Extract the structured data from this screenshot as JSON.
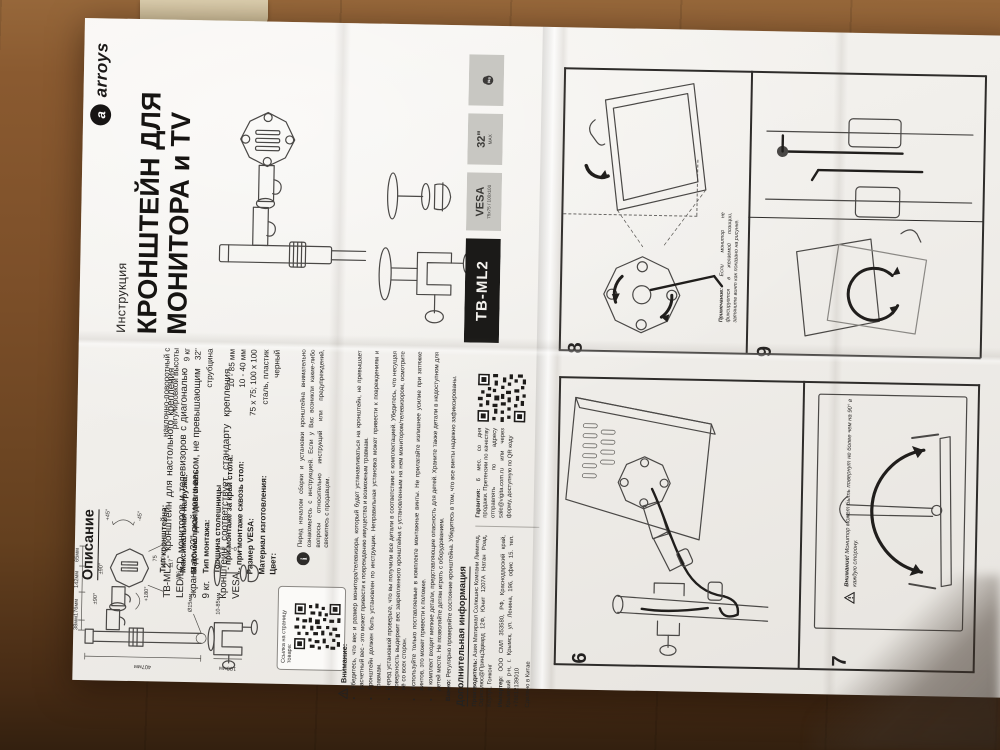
{
  "cover": {
    "brand": "arroys",
    "brand_initial": "a",
    "doc_type": "Инструкция",
    "title_line1": "КРОНШТЕЙН ДЛЯ",
    "title_line2": "МОНИТОРА и TV",
    "badges": {
      "model": "TB-ML2",
      "vesa": "VESA",
      "vesa_sub": "75x75 / 100x100",
      "size": "32\"",
      "size_sub": "MAX",
      "weight": "9kg"
    }
  },
  "description": {
    "title": "Описание",
    "para1": "TB-ML2 - кронштейн для настольного крепления LED/LCD мониторов и телевизоров с диагональю экрана до 32\" дюймов и весом, не превышающим 9 кг.",
    "para2": "Кронштейн соответствует стандарту крепления VESA.",
    "qr_caption": "Ссылка на страницу товара:"
  },
  "specs": {
    "rows": [
      {
        "label": "Тип кронштейна:",
        "value": "наклонно-поворотный с регулировкой высоты"
      },
      {
        "label": "Максимальная нагрузка:",
        "value": "9 кг"
      },
      {
        "label": "Максимальная диагональ:",
        "value": "32\""
      },
      {
        "label": "Тип монтажа:",
        "value": "струбцина"
      },
      {
        "label": "Толщина столешницы",
        "value": ""
      },
      {
        "label": "- при монтаже за край стола:",
        "value": "10 - 85 мм"
      },
      {
        "label": "- при монтаже сквозь стол:",
        "value": "10 - 40 мм"
      },
      {
        "label": "Размер VESA:",
        "value": "75 x 75; 100 x 100"
      },
      {
        "label": "Материал изготовления:",
        "value": "сталь, пластик"
      },
      {
        "label": "Цвет:",
        "value": "черный"
      }
    ]
  },
  "info_note": "Перед началом сборки и установки кронштейна внимательно ознакомьтесь с инструкцией. Если у Вас возникли какие-либо вопросы относительно инструкций или предупреждений, свяжитесь с продавцом.",
  "warnings": {
    "heading": "Внимание:",
    "bullets": [
      "Убедитесь, что вес и размер монитора/телевизора, который будет устанавливаться на кронштейн, не превышает расчетный вес - это может привести к повреждению имущества и возможным травмам.",
      "Кронштейн должен быть установлен по инструкции. Неправильная установка может привести к повреждениям и травмам.",
      "Перед установкой проверьте, что вы получили все детали в соответствии с комплектацией. Убедитесь, что несущая поверхность выдержит вес закрепленного кронштейна с установленным на нем монитором/телевизором, осмотрите её со всех сторон.",
      "Используйте только поставляемые в комплекте монтажные винты. Не прилагайте излишнее усилие при затяжке винтов, это может привести к поломке.",
      "В комплект входят мелкие детали, представляющие опасность для детей. Храните также детали в недоступном для детей месте. Не позволяйте детям играть с оборудованием."
    ],
    "important_label": "Важно:",
    "important": "Регулярно проверяйте состояние кронштейна. Убедитесь в том, что все винты надежно зафиксированы."
  },
  "additional": {
    "heading": "Дополнительная информация",
    "manufacturer_label": "Производитель:",
    "manufacturer": "Азия Матириал Солюшнс Компани Лимитед, Офисплюс@ПринцЭдвард 12Ф, Юнит 1207А Натан Роад, Коулун, Гонконг",
    "importer_label": "Импортер:",
    "importer": "ООО СМЛ 353580, РФ, Краснодарский край, Крымский р-н, г. Крымск, ул. Ленина, 196, офис 15. тел. +78612139010",
    "made_in": "Сделано в Китае",
    "warranty_label": "Гарантия:",
    "warranty": "6 мес. со дня продажи. Претензии по качеству отправлять по адресу sale@vigita.com.ru или через форму, доступную по QR коду"
  },
  "steps": {
    "s6": "6",
    "s7": "7",
    "s8": "8",
    "s9": "9",
    "s8_note_label": "Примечание:",
    "s8_note": "Если монитор не фиксируется в желаемой позиции, затяните винт как показано на рисунке.",
    "s7_warning_label": "Внимание!",
    "s7_warning": "Монитор может быть повернут не более чем на 90° в каждую сторону."
  },
  "dims": {
    "d65": "65мм",
    "d142": "142мм",
    "d176": "176мм",
    "d38": "38мм",
    "d407": "407мм",
    "d100": "100мм",
    "d15": "Ø15мм",
    "r90a": "±90°",
    "r90b": "±90°",
    "r180": "+180°",
    "r45a": "+45°",
    "r45b": "-45°",
    "v75": "75",
    "v100": "100",
    "v116": "116",
    "v117": "117",
    "t1085": "10-85мм",
    "t1040": "10-40мм"
  }
}
